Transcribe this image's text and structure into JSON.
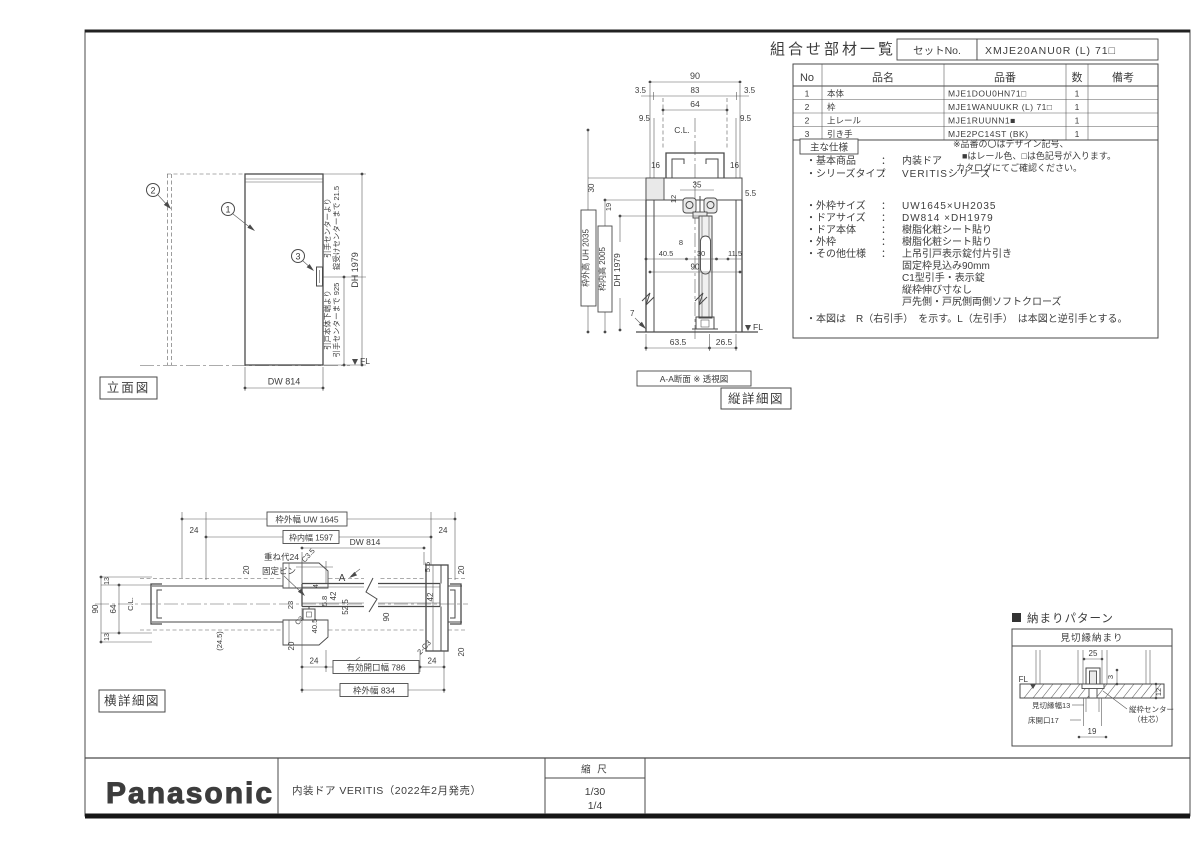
{
  "sheet": {
    "logo": "Panasonic",
    "product_line": "内装ドア VERITIS（2022年2月発売）",
    "scale_label": "縮 尺",
    "scale_value_1": "1/30",
    "scale_value_2": "1/4"
  },
  "parts_table": {
    "title": "組合せ部材一覧表",
    "set_no_label": "セットNo.",
    "set_no_value": "XMJE20ANU0R (L) 71□",
    "col_no": "No",
    "col_name": "品名",
    "col_part_no": "品番",
    "col_qty": "数",
    "col_remarks": "備考",
    "rows": [
      {
        "no": "1",
        "name": "本体",
        "part_no": "MJE1DOU0HN71□",
        "qty": "1"
      },
      {
        "no": "2",
        "name": "枠",
        "part_no": "MJE1WANUUKR (L) 71□",
        "qty": "1"
      },
      {
        "no": "2",
        "name": "上レール",
        "part_no": "MJE1RUUNN1■",
        "qty": "1"
      },
      {
        "no": "3",
        "name": "引き手",
        "part_no": "MJE2PC14ST (BK)",
        "qty": "1"
      }
    ],
    "note_line_1": "※品番の〇はデザイン記号、",
    "note_line_2": "■はレール色、□は色記号が入ります。",
    "note_line_3": "カタログにてご確認ください。"
  },
  "specs": {
    "section_label": "主な仕様",
    "colon": "：",
    "basic_label": "・基本商品",
    "basic_value": "内装ドア",
    "series_label": "・シリーズタイプ",
    "series_value": "VERITISシリーズ",
    "frame_size_label": "・外枠サイズ",
    "frame_size_value": "UW1645×UH2035",
    "door_size_label": "・ドアサイズ",
    "door_size_value": "DW814 ×DH1979",
    "door_body_label": "・ドア本体",
    "door_body_value": "樹脂化粧シート貼り",
    "outer_frame_label": "・外枠",
    "outer_frame_value": "樹脂化粧シート貼り",
    "other_label": "・その他仕様",
    "other_value_1": "上吊引戸表示錠付片引き",
    "other_value_2": "固定枠見込み90mm",
    "other_value_3": "C1型引手・表示錠",
    "other_value_4": "縦枠伸び寸なし",
    "other_value_5": "戸先側・戸尻側両側ソフトクローズ",
    "footnote": "・本図は　R（右引手）　を示す。L（左引手）　は本図と逆引手とする。"
  },
  "elevation": {
    "label": "立面図",
    "callout_1": "1",
    "callout_2": "2",
    "callout_3": "3",
    "dim_door_width": "DW 814",
    "dim_door_height": "DH 1979",
    "handle_note_top_1": "引手センターより",
    "handle_note_top_2": "錠受けセンターまで 21.5",
    "handle_note_bottom_1": "引戸本体下端より",
    "handle_note_bottom_2": "引手センターまで 925",
    "floor_level": "FL"
  },
  "vertical_section": {
    "label": "縦詳細図",
    "caption": "A-A断面 ※ 透視図",
    "dim_90_top": "90",
    "dim_3_5_left": "3.5",
    "dim_83": "83",
    "dim_3_5_right": "3.5",
    "dim_64": "64",
    "dim_9_5_left": "9.5",
    "dim_9_5_right": "9.5",
    "center_line": "C.L.",
    "dim_16_left": "16",
    "dim_16_right": "16",
    "dim_35": "35",
    "dim_5_5": "5.5",
    "dim_12": "12",
    "dim_30_left": "30",
    "dim_19": "19",
    "dim_8": "8",
    "dim_40_5": "40.5",
    "dim_30_mid": "30",
    "dim_11_5": "11.5",
    "dim_90_mid": "90",
    "frame_outer_height": "枠外高 UH 2035",
    "frame_inner_height": "枠内高 2005",
    "dim_door_height": "DH 1979",
    "dim_7": "7",
    "floor_level": "FL",
    "dim_63_5": "63.5",
    "dim_26_5": "26.5"
  },
  "horizontal_section": {
    "label": "横詳細図",
    "frame_outer_width": "枠外幅 UW 1645",
    "frame_inner_width": "枠内幅 1597",
    "dim_24_top_left": "24",
    "dim_24_top_right": "24",
    "dim_door_width": "DW 814",
    "overlap_note": "重ね代24",
    "fixed_pin_note": "固定ピン",
    "section_mark_top": "A",
    "section_mark_bottom": "A",
    "dim_20_top_left": "20",
    "chamfer_c3_5": "C3.5",
    "dim_4": "4",
    "dim_42_left": "42",
    "dim_52_5": "52.5",
    "dim_90_left": "90",
    "dim_64": "64",
    "center_line": "C.L.",
    "dim_13_top": "13",
    "dim_13_bottom": "13",
    "dim_24_5": "(24.5)",
    "dim_23": "23",
    "chamfer_c3": "C3",
    "dim_40_5": "40.5",
    "dim_5_8": "5.8",
    "dim_20_bottom_left": "20",
    "dim_5_5": "5.5",
    "dim_20_right_top": "20",
    "dim_42_right": "42",
    "dim_90_mid": "90",
    "chamfer_2c3": "2-C3",
    "dim_20_right_bottom": "20",
    "dim_24_bottom_left": "24",
    "effective_opening": "有効開口幅 786",
    "dim_24_bottom_right": "24",
    "frame_outer_width_2": "枠外幅 834"
  },
  "pattern": {
    "header": "納まりパターン",
    "box_title": "見切縁納まり",
    "floor_level": "FL",
    "dim_25": "25",
    "dim_3": "3",
    "dim_12": "12",
    "dim_19": "19",
    "trim_width_note": "見切縁幅13",
    "floor_opening_note": "床開口17",
    "center_note_1": "縦枠センター",
    "center_note_2": "（柱芯）"
  }
}
